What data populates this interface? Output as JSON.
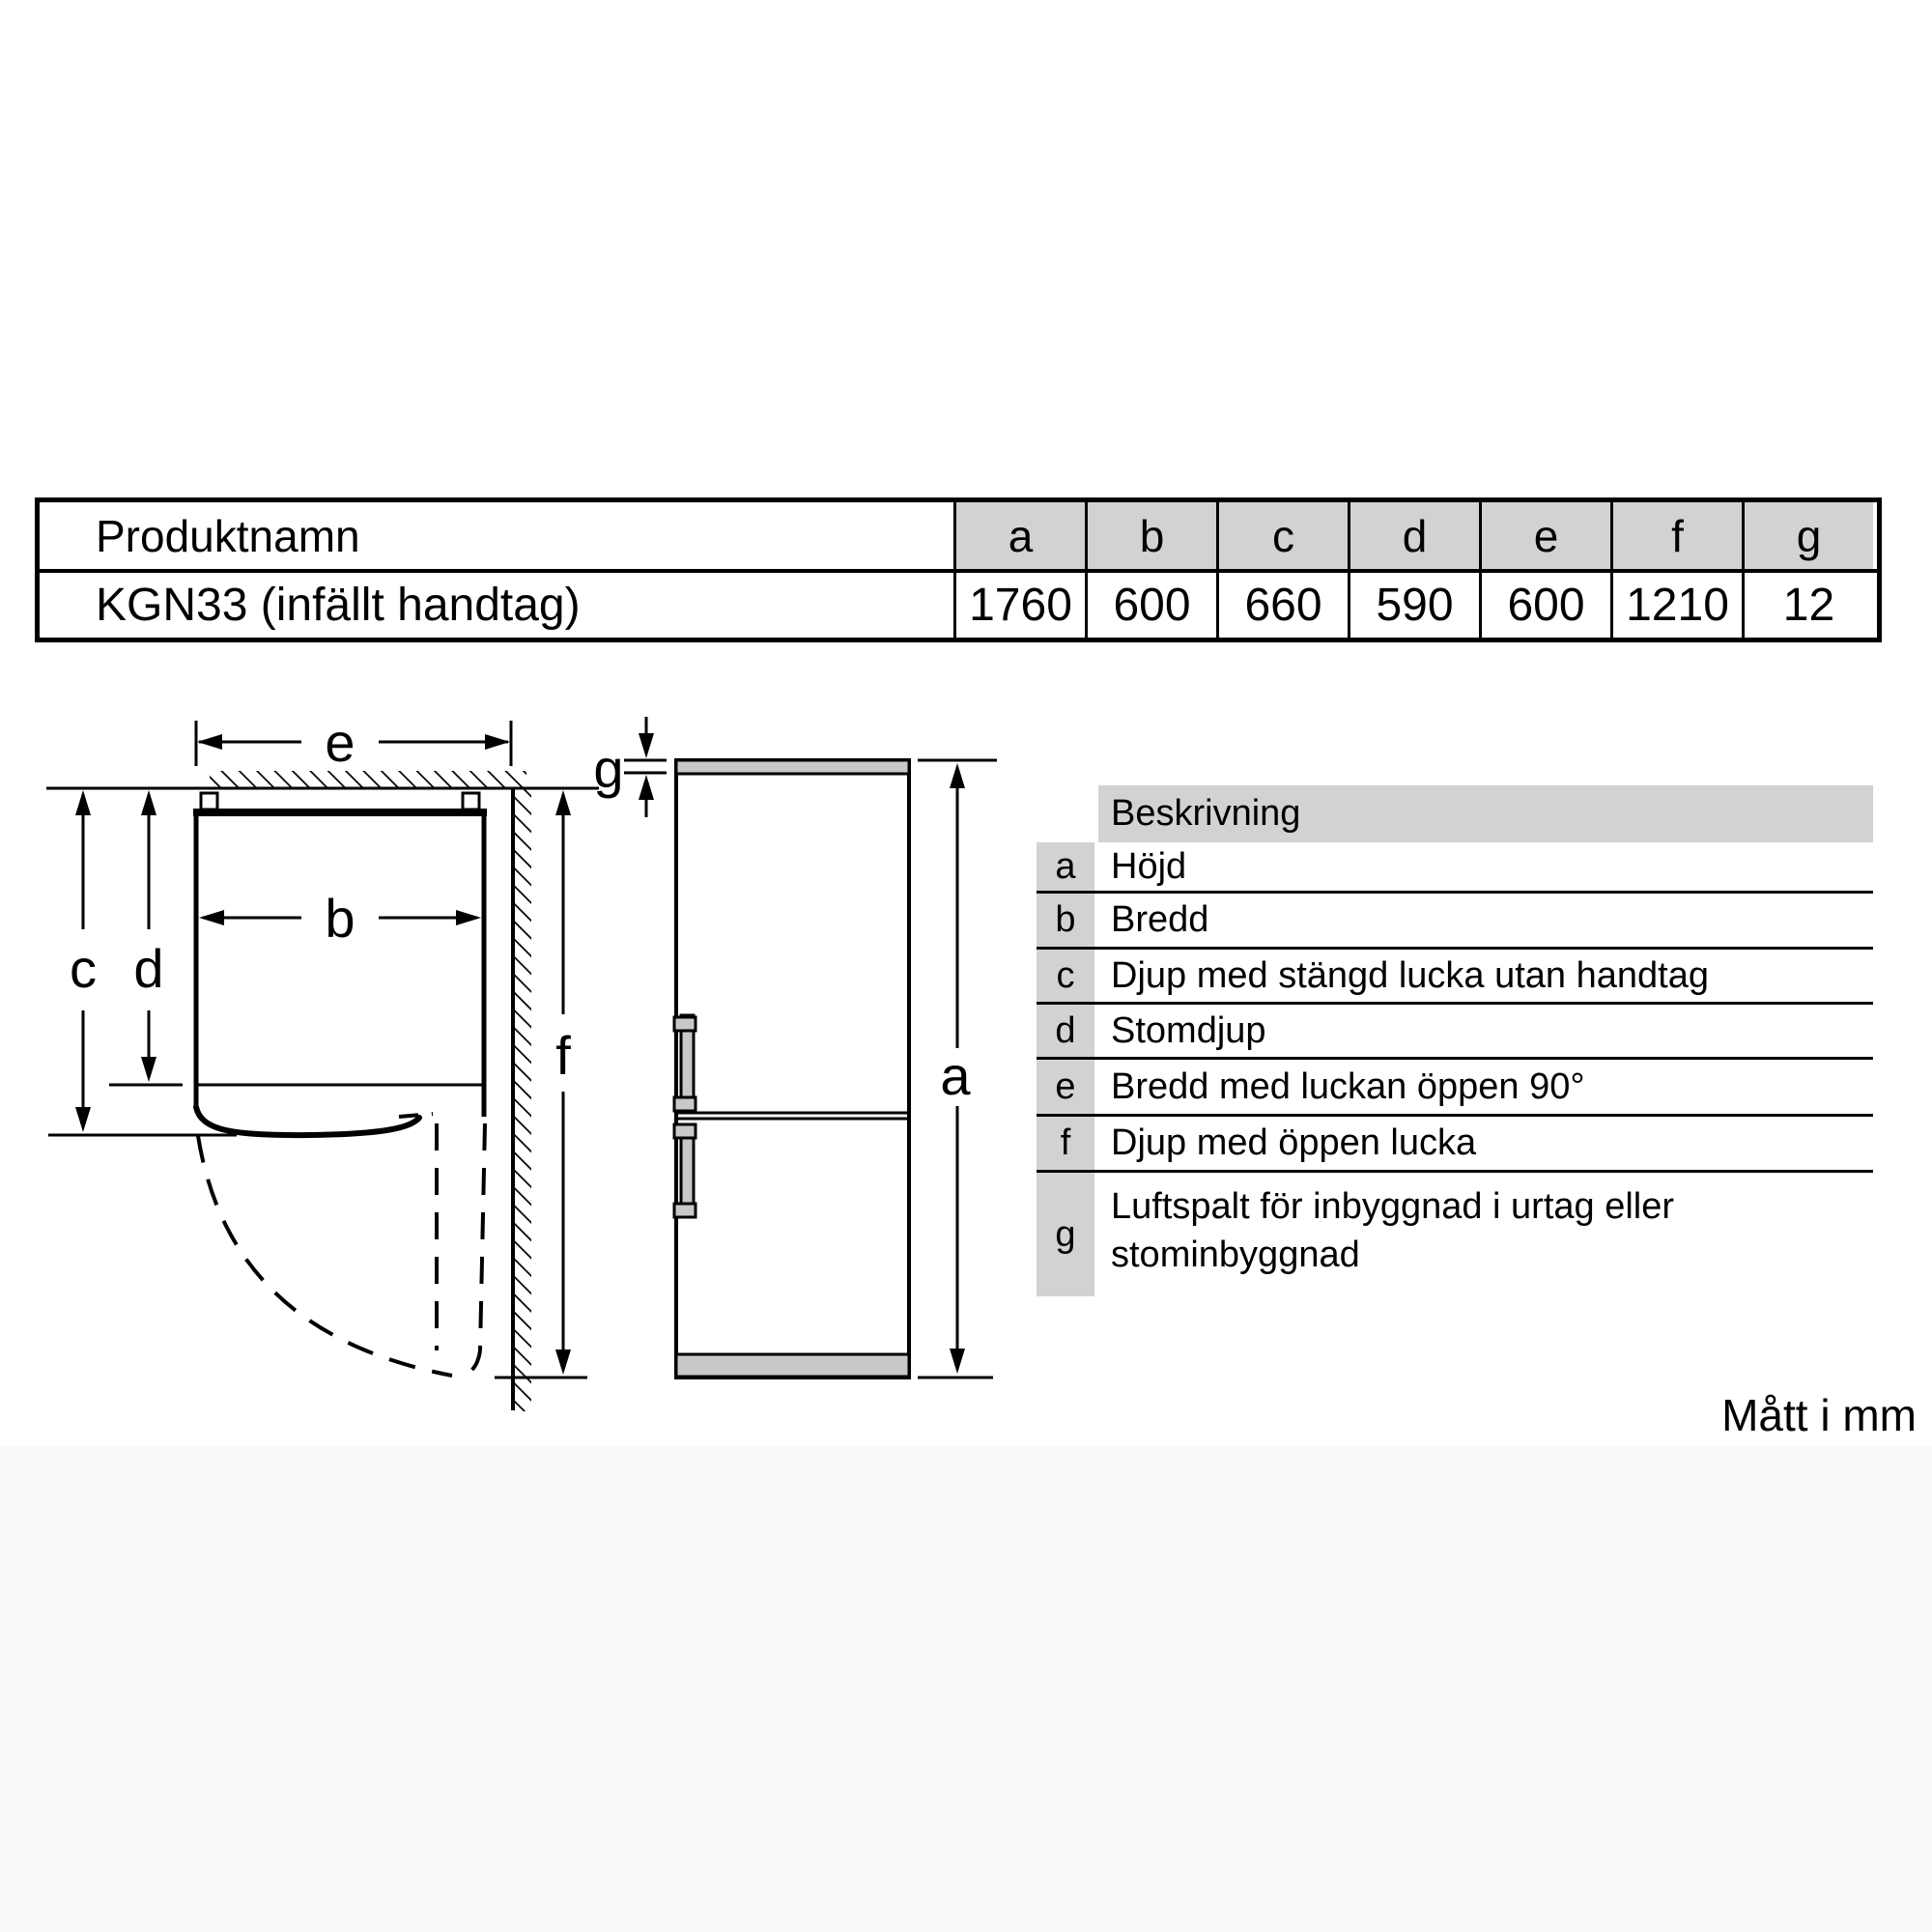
{
  "product_table": {
    "name_header": "Produktnamn",
    "dim_headers": [
      "a",
      "b",
      "c",
      "d",
      "e",
      "f",
      "g"
    ],
    "row": {
      "name": "KGN33 (infällt handtag)",
      "values": [
        "1760",
        "600",
        "660",
        "590",
        "600",
        "1210",
        "12"
      ]
    }
  },
  "legend": {
    "header": "Beskrivning",
    "rows": [
      {
        "key": "a",
        "desc": "Höjd"
      },
      {
        "key": "b",
        "desc": "Bredd"
      },
      {
        "key": "c",
        "desc": "Djup med stängd lucka utan handtag"
      },
      {
        "key": "d",
        "desc": "Stomdjup"
      },
      {
        "key": "e",
        "desc": "Bredd med luckan öppen 90°"
      },
      {
        "key": "f",
        "desc": "Djup med öppen lucka"
      },
      {
        "key": "g",
        "desc": "Luftspalt för inbyggnad i urtag eller stominbyggnad"
      }
    ]
  },
  "diagram": {
    "dimension_labels": {
      "e": "e",
      "b": "b",
      "c": "c",
      "d": "d",
      "f": "f",
      "g": "g",
      "a": "a"
    }
  },
  "footer": {
    "units_note": "Mått i mm"
  },
  "colors": {
    "table_header_gray": "#d2d2d2",
    "legend_gray": "#d2d2d2",
    "fridge_gray": "#c8c8c8",
    "line_black": "#000000",
    "bottom_band": "#fafafa"
  }
}
